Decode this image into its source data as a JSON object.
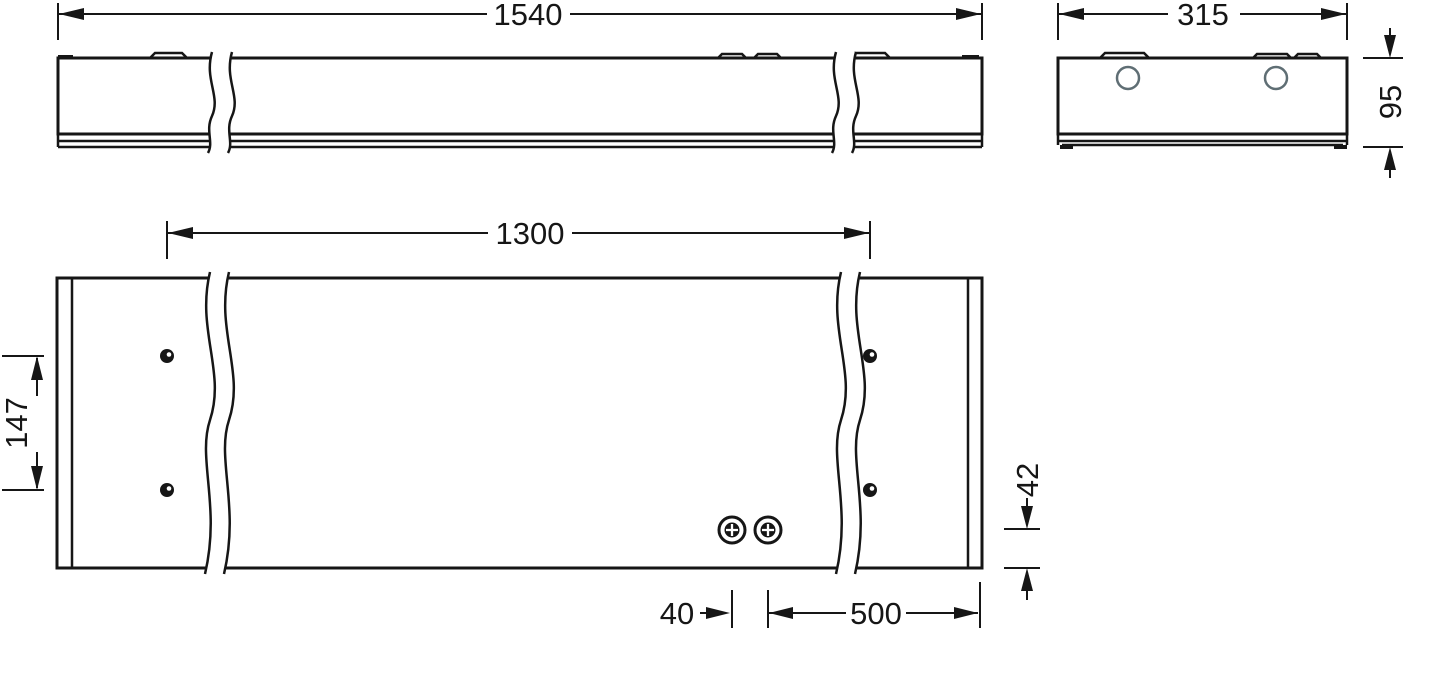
{
  "dimensions": {
    "overall_length": "1540",
    "overall_width": "315",
    "overall_height": "95",
    "mounting_length": "1300",
    "mounting_width": "147",
    "mounting_edge_offset": "42",
    "screw_spacing": "40",
    "screw_end_distance": "500"
  },
  "colors": {
    "line": "#161616",
    "knockout_circle": "#5f6e74",
    "background": "#ffffff"
  }
}
